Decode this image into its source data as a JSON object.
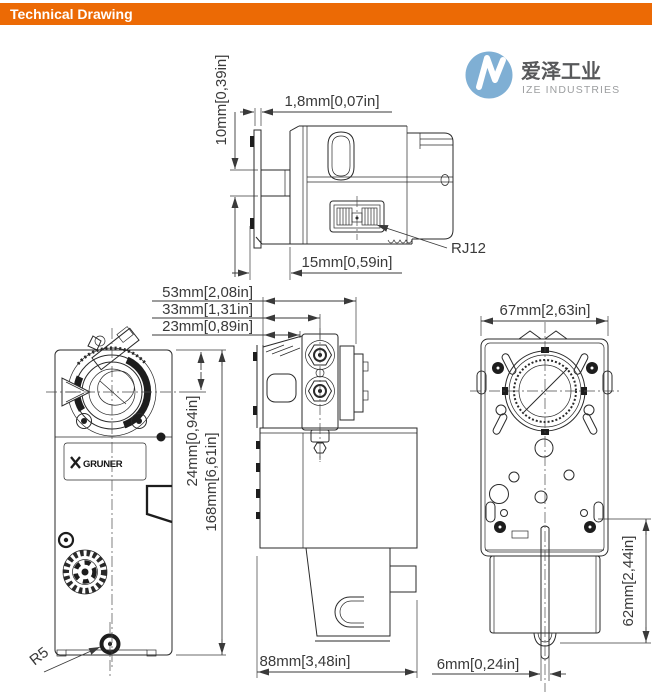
{
  "header": {
    "title": "Technical Drawing",
    "bg_color": "#EC6A05"
  },
  "logo": {
    "cn": "爱泽工业",
    "en": "IZE INDUSTRIES",
    "disc_color": "#7FAFD4"
  },
  "callouts": {
    "rj12": "RJ12",
    "r5": "R5"
  },
  "front": {
    "brand": "GRUNER"
  },
  "dims": {
    "top": {
      "h10": "10mm[0,39in]",
      "t18": "1,8mm[0,07in]",
      "d15": "15mm[0,59in]"
    },
    "stack": {
      "d53": "53mm[2,08in]",
      "d33": "33mm[1,31in]",
      "d23": "23mm[0,89in]"
    },
    "front": {
      "d24": "24mm[0,94in]",
      "h168": "168mm[6,61in]"
    },
    "side": {
      "w88": "88mm[3,48in]"
    },
    "back": {
      "w67": "67mm[2,63in]",
      "h62": "62mm[2,44in]",
      "s6": "6mm[0,24in]"
    }
  }
}
